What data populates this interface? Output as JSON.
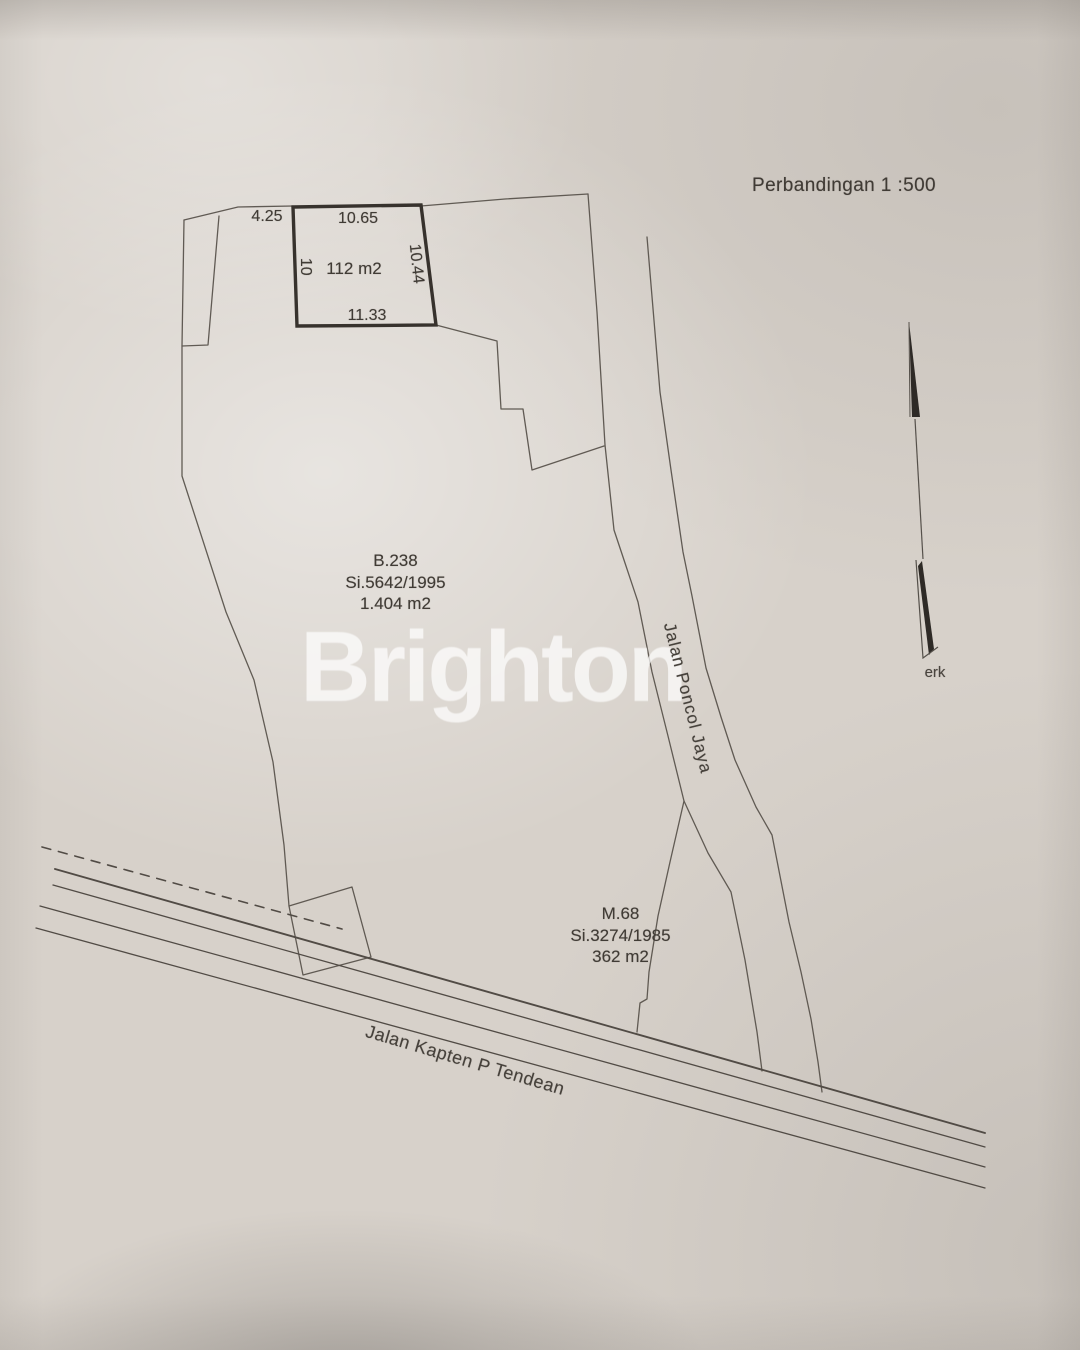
{
  "scale": {
    "label": "Perbandingan 1 :500"
  },
  "watermark": {
    "text": "Brighton"
  },
  "north_arrow": {
    "caption": "erk"
  },
  "highlight_plot": {
    "area_label": "112 m2",
    "dim_top": "10.65",
    "dim_left": "10",
    "dim_right": "10.44",
    "dim_bottom": "11.33",
    "dim_offset_left": "4.25"
  },
  "parcel_b238": {
    "id": "B.238",
    "certificate": "Si.5642/1995",
    "area": "1.404 m2"
  },
  "parcel_m68": {
    "id": "M.68",
    "certificate": "Si.3274/1985",
    "area": "362 m2"
  },
  "streets": {
    "poncol": "Jalan Poncol Jaya",
    "tendean": "Jalan Kapten P Tendean"
  },
  "colors": {
    "paper": "#d7d1ca",
    "ink_thin": "#5a544d",
    "ink_bold": "#37322d",
    "arrow_fill": "#2e2a26",
    "watermark": "#ffffff"
  }
}
